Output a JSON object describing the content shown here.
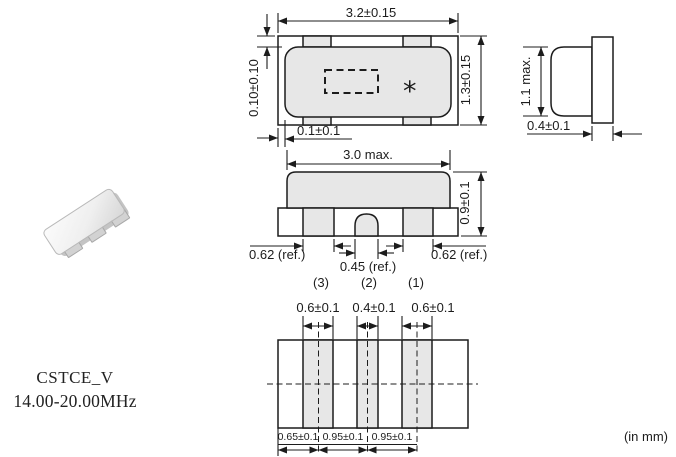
{
  "part": {
    "series": "CSTCE_V",
    "frequency_range": "14.00-20.00MHz"
  },
  "units_note": "(in mm)",
  "colors": {
    "line": "#1c1c1c",
    "fill_gray": "#e7e7e7",
    "text": "#1c1c1c"
  },
  "views": {
    "top": {
      "width": "3.2±0.15",
      "height": "1.3±0.15",
      "cap_offset_top": "0.10±0.10",
      "cap_offset_left": "0.1±0.1",
      "marking": "*"
    },
    "side": {
      "height": "1.1 max.",
      "substrate_thickness": "0.4±0.1"
    },
    "front": {
      "cap_width": "3.0 max.",
      "height": "0.9±0.1",
      "pad_dims": [
        "0.62 (ref.)",
        "0.45 (ref.)",
        "0.62 (ref.)"
      ],
      "terminals": [
        "(3)",
        "(2)",
        "(1)"
      ]
    },
    "land": {
      "top_dims": [
        "0.6±0.1",
        "0.4±0.1",
        "0.6±0.1"
      ],
      "bottom_dims": [
        "0.65±0.1",
        "0.95±0.1",
        "0.95±0.1"
      ]
    }
  }
}
